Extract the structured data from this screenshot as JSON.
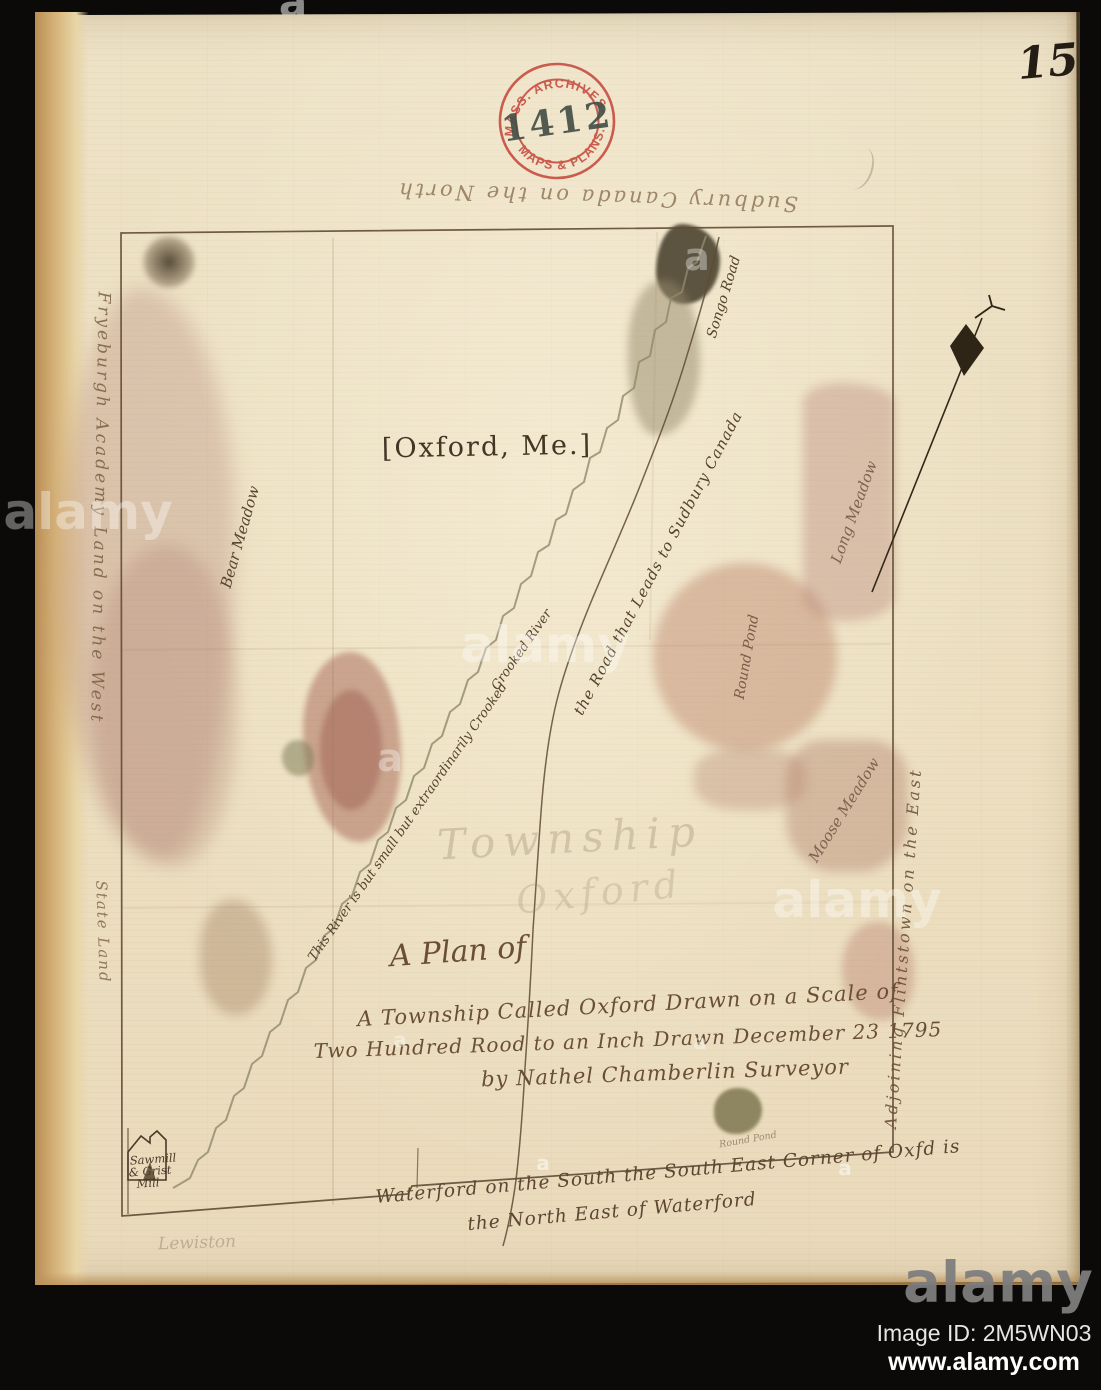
{
  "colors": {
    "paper": "#ece0c4",
    "paper_edge": "#d3ad72",
    "ink_brown": "#5d4631",
    "stamp_red": "#c6493c",
    "stamp_number_ink": "#2e3b35",
    "stain_pink": "#b98a7e",
    "stain_olive": "#8a8159",
    "background_black": "#0b0a08",
    "watermark_white": "#ffffff"
  },
  "photo": {
    "page_number": "15"
  },
  "stamp": {
    "arc_top": "MASS. ARCHIVES.",
    "arc_bottom": "MAPS & PLANS.",
    "number": "1412"
  },
  "map": {
    "bracket_title": "[Oxford, Me.]",
    "border_notes": {
      "north": "Sudbury Canada on the North",
      "west": "Fryeburgh Academy Land on the West",
      "east": "Adjoining Flintstown on the East",
      "state_land": "State Land",
      "south_line1": "Waterford on the South the South East Corner of Oxfd is",
      "south_line2": "the North East of Waterford"
    },
    "features": {
      "bear_meadow": "Bear Meadow",
      "long_meadow": "Long Meadow",
      "moose_meadow": "Moose Meadow",
      "round_pond": "Round Pond",
      "round_pond_small": "Round Pond",
      "songo_road": "Songo Road",
      "road_note": "the Road that Leads to Sudbury Canada",
      "river_note": "This River is but small but extraordinarily Crooked",
      "river_name": "Crooked River",
      "mill_line1": "Sawmill",
      "mill_line2": "& Grist",
      "mill_line3": "Mill",
      "pencil_township": "Township",
      "pencil_oxford": "Oxford",
      "pencil_name": "Lewiston"
    },
    "title_block": {
      "line1": "A Plan of",
      "line2": "A Township Called Oxford Drawn on a Scale of",
      "line3": "Two Hundred Rood to an Inch Drawn December 23 1795",
      "line4": "by Nathel Chamberlin Surveyor"
    }
  },
  "watermark": {
    "logo": "alamy",
    "letter": "a",
    "image_id": "Image ID: 2M5WN03",
    "url": "www.alamy.com"
  }
}
